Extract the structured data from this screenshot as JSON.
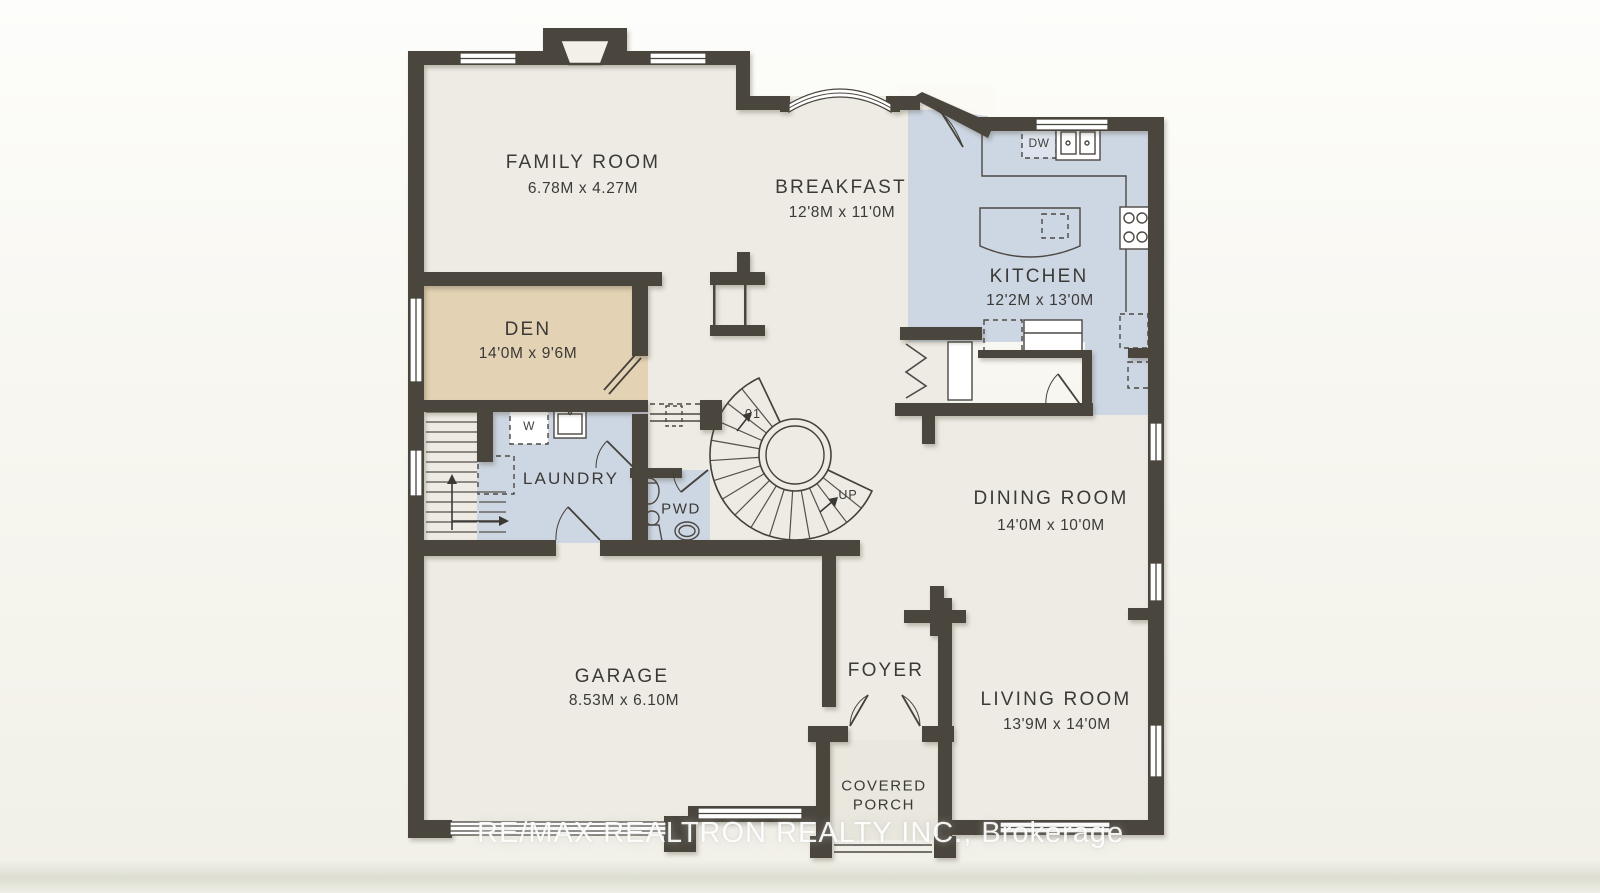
{
  "watermark": {
    "text": "RE/MAX REALTRON REALTY INC., Brokerage"
  },
  "rooms": {
    "family_room": {
      "name": "FAMILY ROOM",
      "dims": "6.78M x 4.27M"
    },
    "breakfast": {
      "name": "BREAKFAST",
      "dims": "12'8M x 11'0M"
    },
    "kitchen": {
      "name": "KITCHEN",
      "dims": "12'2M x 13'0M"
    },
    "den": {
      "name": "DEN",
      "dims": "14'0M x 9'6M"
    },
    "laundry": {
      "name": "LAUNDRY"
    },
    "powder_room": {
      "name": "PWD"
    },
    "dining_room": {
      "name": "DINING ROOM",
      "dims": "14'0M x 10'0M"
    },
    "garage": {
      "name": "GARAGE",
      "dims": "8.53M x 6.10M"
    },
    "foyer": {
      "name": "FOYER"
    },
    "living_room": {
      "name": "LIVING ROOM",
      "dims": "13'9M x 14'0M"
    },
    "covered_porch": {
      "line1": "COVERED",
      "line2": "PORCH"
    }
  },
  "annotations": {
    "stair_level": "01",
    "stair_direction": "UP",
    "washer": "W",
    "dishwasher": "DW"
  },
  "colors": {
    "wall": "#4a463e",
    "floor": "#edebe3",
    "kitchen_floor": "#cdd6e3",
    "den_floor": "#e3d2b4",
    "background": "#f8f7f1"
  }
}
